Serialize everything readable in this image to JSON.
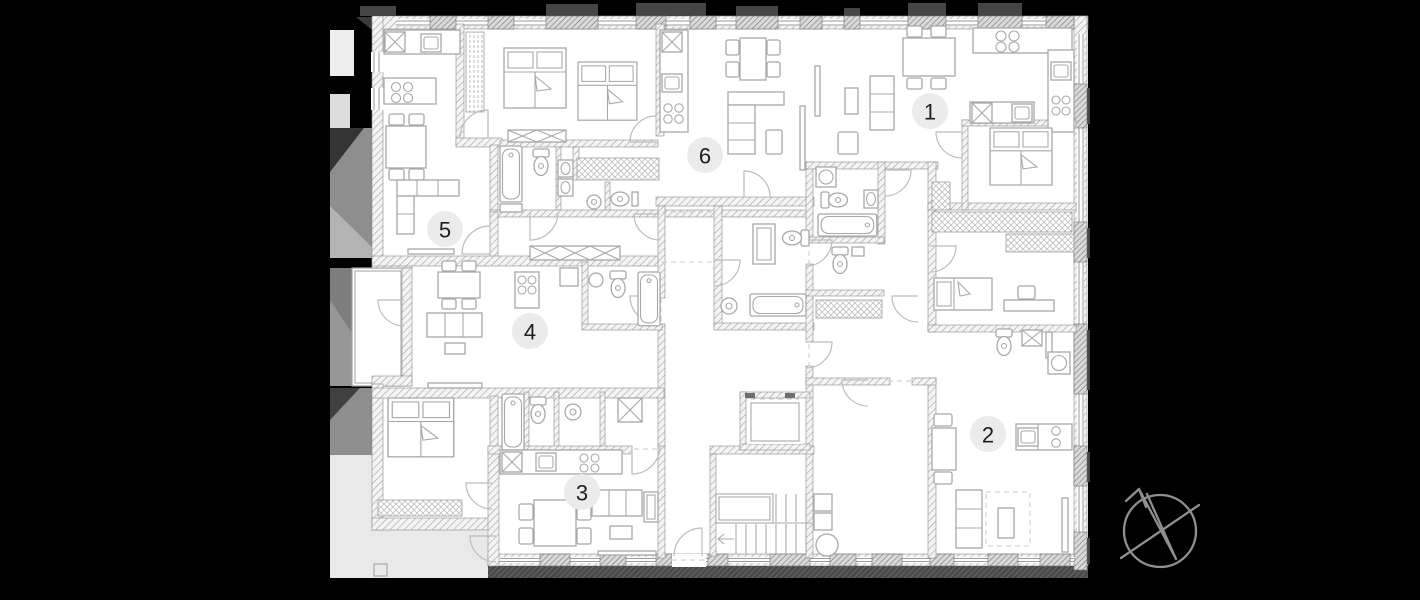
{
  "scene": {
    "type": "architectural-floor-plan",
    "description": "Residential building floor plan with six numbered apartment units, stair core, elevator and north compass"
  },
  "canvas": {
    "width": 1420,
    "height": 600,
    "background": "#000000"
  },
  "floor_plan": {
    "floor_fill": "#ffffff",
    "wall_hatch_color": "#9a9a9a",
    "wall_dark_color": "#454545",
    "furniture_line_color": "#a8a8a8",
    "door_arc_color": "#bcbcbc",
    "terrace_fill": "#e9e9e9",
    "shadow_grays": [
      "#8e8e8e",
      "#353535",
      "#b4b4b4",
      "#7d7d7d"
    ],
    "unit_badges": [
      {
        "number": "1",
        "cx": 930,
        "cy": 111
      },
      {
        "number": "2",
        "cx": 988,
        "cy": 434
      },
      {
        "number": "3",
        "cx": 582,
        "cy": 492
      },
      {
        "number": "4",
        "cx": 530,
        "cy": 331
      },
      {
        "number": "5",
        "cx": 445,
        "cy": 229
      },
      {
        "number": "6",
        "cx": 705,
        "cy": 155
      }
    ],
    "badge_style": {
      "radius": 18,
      "fill": "#ebebeb",
      "text_color": "#1f1f1f",
      "font_size": 22
    }
  },
  "icons": {
    "compass": "compass-north-arrow"
  },
  "compass": {
    "cx": 1160,
    "cy": 531,
    "radius": 36,
    "color": "#8f8f8f"
  }
}
